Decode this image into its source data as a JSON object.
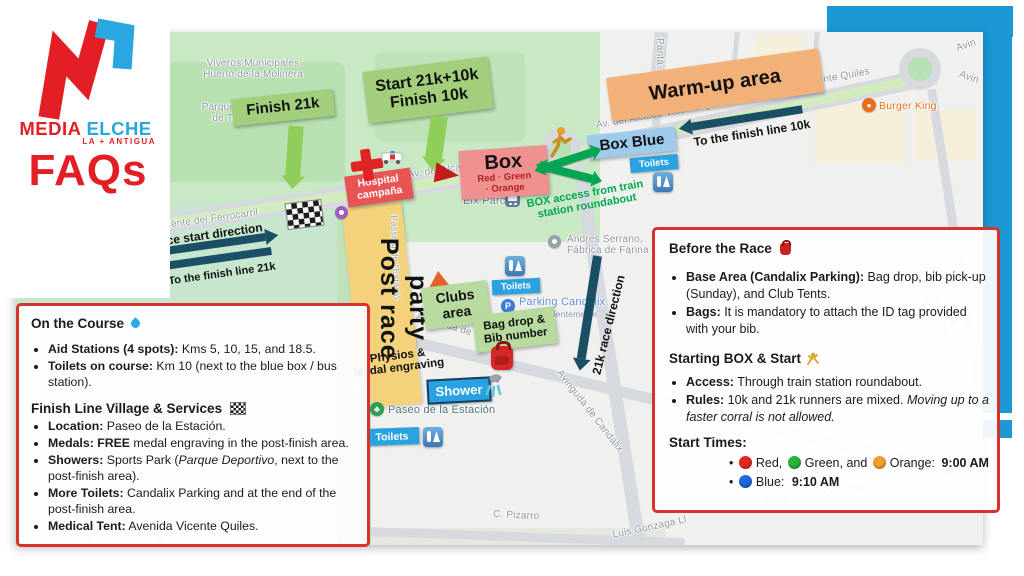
{
  "logo": {
    "brand_media": "MEDIA",
    "brand_elche": "ELCHE",
    "brand_sub": "LA + ANTIGUA",
    "faqs": "FAQs"
  },
  "colors": {
    "accent_blue": "#1a99d5",
    "brand_red": "#e31e24",
    "brand_blue": "#2ba7df",
    "route_green": "#00a651",
    "arrow_navy": "#1a4f66",
    "label_green": "#a3cf7d",
    "label_orange": "#f2b179",
    "label_salmon": "#f19090",
    "label_lightblue": "#9ecbec",
    "toilets_blue": "#29a2e2",
    "hospital_red": "#e85454",
    "box_border_red": "#d93030",
    "start_dot_red": "#e02a20",
    "start_dot_green": "#28b33c",
    "start_dot_orange": "#f0a02c",
    "start_dot_blue": "#1f66e0"
  },
  "map": {
    "streets": {
      "viveros": "Viveros Municipales\nHuerto de la Molinera",
      "parque_infantil": "Parque Infantil\nde Tráfico",
      "parque_municipal": "Parque\nMunicipal",
      "panta": "Pantà",
      "puente": "Puente del Ferrocarril",
      "passeig": "Passeig de l'Estació",
      "av_quiles": "Av. del Alcalde Vicente Quiles",
      "avinguda": "Avinguda de Candalix",
      "pizarro": "C. Pizarro",
      "luis": "Luis Gonzaga Ll",
      "cami": "Camí de la Bassa del",
      "avin": "Avin"
    },
    "pois": {
      "elx_parc": "Elx Parc",
      "burger": "Burger King",
      "andres": "Andres Serrano,\nFábrica de Farina",
      "parking": "Parking Candalix",
      "parking_sub": "Visto recientemente",
      "paseo": "Paseo de la Estación"
    },
    "overlays": {
      "finish21k": "Finish 21k",
      "start": "Start 21k+10k\nFinish 10k",
      "warmup": "Warm-up area",
      "box_blue": "Box Blue",
      "toilets": "Toilets",
      "finish10k_dir": "To the finish line 10k",
      "box_title": "Box",
      "box_sub": "Red · Green\n· Orange",
      "hospital": "Hospital\ncampaña",
      "box_access": "BOX access from train\nstation roundabout",
      "race_start_dir": "Race start direction",
      "finish21k_dir": "To the finish line 21k",
      "post_race": "Post race",
      "party": "party",
      "physios": "Physios &\nMedal engraving",
      "clubs": "Clubs\narea",
      "bag_drop": "Bag drop &\nBib number",
      "shower": "Shower",
      "race_dir_21k": "21k race direction"
    }
  },
  "on_course": {
    "title": "On the Course",
    "b1_lead": "Aid Stations (4 spots):",
    "b1_text": " Kms 5, 10, 15, and 18.5.",
    "b2_lead": "Toilets on course:",
    "b2_text": " Km 10 (next to the blue box / bus station).",
    "subtitle": "Finish Line Village & Services",
    "b3_lead": "Location:",
    "b3_text": " Paseo de la Estación.",
    "b4_lead": "Medals: FREE",
    "b4_text": " medal engraving in the post-finish area.",
    "b5_lead": "Showers:",
    "b5_t1": " Sports Park (",
    "b5_italic": "Parque Deportivo",
    "b5_t2": ", next to the post-finish area).",
    "b6_lead": "More Toilets:",
    "b6_text": " Candalix Parking and at the end of the post-finish area.",
    "b7_lead": "Medical Tent:",
    "b7_text": " Avenida Vicente Quiles."
  },
  "before_race": {
    "title": "Before the Race",
    "b1_lead": "Base Area (Candalix Parking):",
    "b1_text": " Bag drop, bib pick-up (Sunday), and Club Tents.",
    "b2_lead": "Bags:",
    "b2_text": " It is mandatory to attach the ID tag provided with your bib.",
    "subtitle": "Starting BOX & Start",
    "b3_lead": "Access:",
    "b3_text": " Through train station roundabout.",
    "b4_lead": "Rules:",
    "b4_t1": " 10k and 21k runners are mixed. ",
    "b4_italic": "Moving up to a faster corral is not allowed.",
    "start_times": "Start Times:",
    "t1_red": "Red,",
    "t1_green": "Green, and",
    "t1_orange": "Orange:",
    "t1_time": "9:00 AM",
    "t2_blue": "Blue:",
    "t2_time": "9:10 AM"
  }
}
